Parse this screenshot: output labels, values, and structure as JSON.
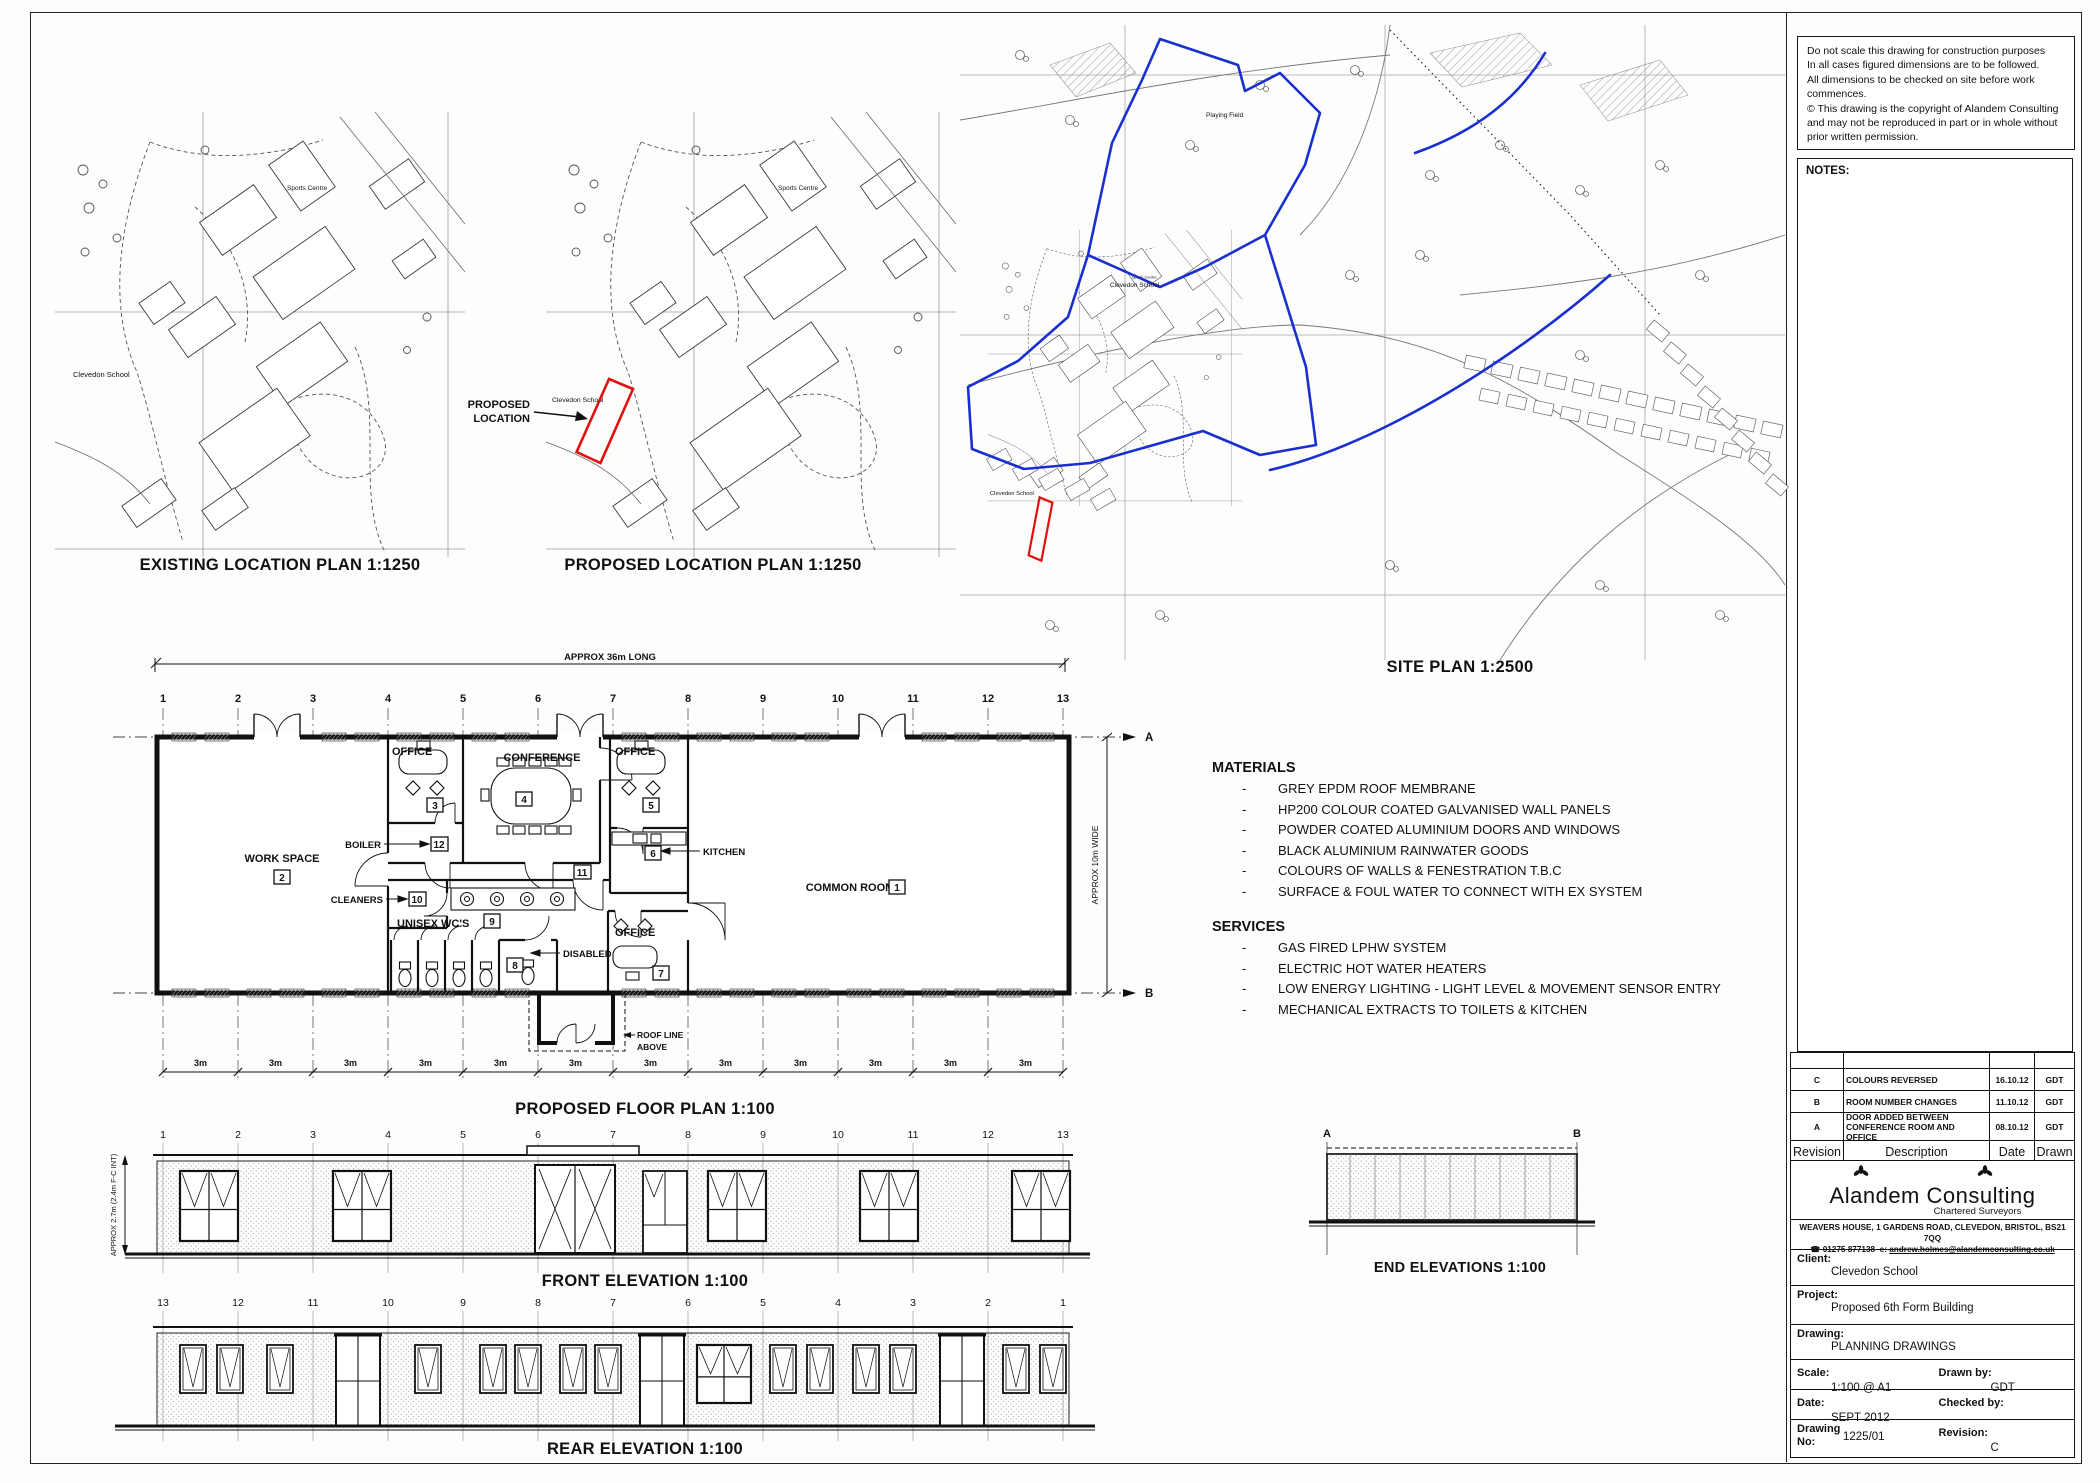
{
  "bullet": "-",
  "disclaimer": {
    "lines": [
      "Do not scale this drawing for construction purposes",
      "In all cases figured dimensions are to be followed.",
      "All dimensions to be checked on site before work",
      "commences.",
      "© This drawing is the copyright of Alandem Consulting",
      "and may not be reproduced in part or in whole without",
      "prior written permission."
    ]
  },
  "notes": {
    "label": "NOTES:"
  },
  "location_plans": {
    "existing_title": "EXISTING LOCATION PLAN 1:1250",
    "proposed_title": "PROPOSED LOCATION PLAN 1:1250",
    "school_label": "Clevedon School",
    "sports_centre_label": "Sports Centre",
    "callout_line1": "PROPOSED",
    "callout_line2": "LOCATION",
    "highlight_color": "#e01010"
  },
  "site_plan": {
    "title": "SITE PLAN 1:2500",
    "school_label": "Clevedon School",
    "playing_field_label": "Playing Field",
    "boundary_color": "#1a2fd0"
  },
  "floor_plan": {
    "title": "PROPOSED FLOOR PLAN 1:100",
    "length_dim": "APPROX 36m LONG",
    "width_dim": "APPROX 10m WIDE",
    "bay_dim": "3m",
    "grid": [
      "1",
      "2",
      "3",
      "4",
      "5",
      "6",
      "7",
      "8",
      "9",
      "10",
      "11",
      "12",
      "13"
    ],
    "section_a": "A",
    "section_b": "B",
    "roof_note_line1": "ROOF LINE",
    "roof_note_line2": "ABOVE",
    "rooms": {
      "common_room": {
        "name": "COMMON ROOM",
        "no": "1"
      },
      "work_space": {
        "name": "WORK SPACE",
        "no": "2"
      },
      "office3": {
        "name": "OFFICE",
        "no": "3"
      },
      "conference": {
        "name": "CONFERENCE",
        "no": "4"
      },
      "office5": {
        "name": "OFFICE",
        "no": "5"
      },
      "kitchen": {
        "name": "KITCHEN",
        "no": "6"
      },
      "office7": {
        "name": "OFFICE",
        "no": "7"
      },
      "disabled": {
        "name": "DISABLED",
        "no": "8"
      },
      "unisex_wcs": {
        "name": "UNISEX WC'S",
        "no": "9"
      },
      "cleaners": {
        "name": "CLEANERS",
        "no": "10"
      },
      "corridor": {
        "no": "11"
      },
      "boiler": {
        "name": "BOILER",
        "no": "12"
      }
    }
  },
  "front_elevation": {
    "title": "FRONT ELEVATION 1:100",
    "height_dim": "APPROX 2.7m (2.4m F-C INT)"
  },
  "rear_elevation": {
    "title": "REAR ELEVATION 1:100"
  },
  "end_elevations": {
    "title": "END ELEVATIONS 1:100",
    "marker_a": "A",
    "marker_b": "B"
  },
  "materials": {
    "heading": "MATERIALS",
    "items": [
      "GREY EPDM ROOF MEMBRANE",
      "HP200 COLOUR COATED GALVANISED WALL PANELS",
      "POWDER COATED ALUMINIUM DOORS AND WINDOWS",
      "BLACK ALUMINIUM RAINWATER GOODS",
      "COLOURS OF WALLS & FENESTRATION T.B.C",
      "SURFACE & FOUL WATER TO CONNECT WITH EX SYSTEM"
    ]
  },
  "services": {
    "heading": "SERVICES",
    "items": [
      "GAS FIRED LPHW SYSTEM",
      "ELECTRIC HOT WATER HEATERS",
      "LOW ENERGY LIGHTING - LIGHT LEVEL & MOVEMENT SENSOR ENTRY",
      "MECHANICAL EXTRACTS TO TOILETS & KITCHEN"
    ]
  },
  "revisions": {
    "rows": [
      {
        "rev": "C",
        "description": "COLOURS REVERSED",
        "date": "16.10.12",
        "drawn": "GDT"
      },
      {
        "rev": "B",
        "description": "ROOM NUMBER CHANGES",
        "date": "11.10.12",
        "drawn": "GDT"
      },
      {
        "rev": "A",
        "description": "DOOR ADDED BETWEEN CONFERENCE ROOM AND OFFICE",
        "date": "08.10.12",
        "drawn": "GDT"
      }
    ],
    "footer": {
      "rev": "Revision",
      "description": "Description",
      "date": "Date",
      "drawn": "Drawn"
    }
  },
  "title_block": {
    "company": "Alandem Consulting",
    "tagline": "Chartered Surveyors",
    "address": "WEAVERS HOUSE, 1 GARDENS ROAD, CLEVEDON, BRISTOL, BS21 7QQ",
    "phone_icon": "☎",
    "phone": "01275 877138",
    "email_prefix": "e:",
    "email": "andrew.holmes@alandemconsulting.co.uk",
    "client_label": "Client:",
    "client": "Clevedon School",
    "project_label": "Project:",
    "project": "Proposed 6th Form Building",
    "drawing_label": "Drawing:",
    "drawing": "PLANNING DRAWINGS",
    "scale_label": "Scale:",
    "scale": "1:100 @ A1",
    "drawn_by_label": "Drawn by:",
    "drawn_by": "GDT",
    "date_label": "Date:",
    "date": "SEPT 2012",
    "checked_by_label": "Checked by:",
    "checked_by": "",
    "drawing_no_label": "Drawing No:",
    "drawing_no": "1225/01",
    "revision_label": "Revision:",
    "revision": "C"
  }
}
